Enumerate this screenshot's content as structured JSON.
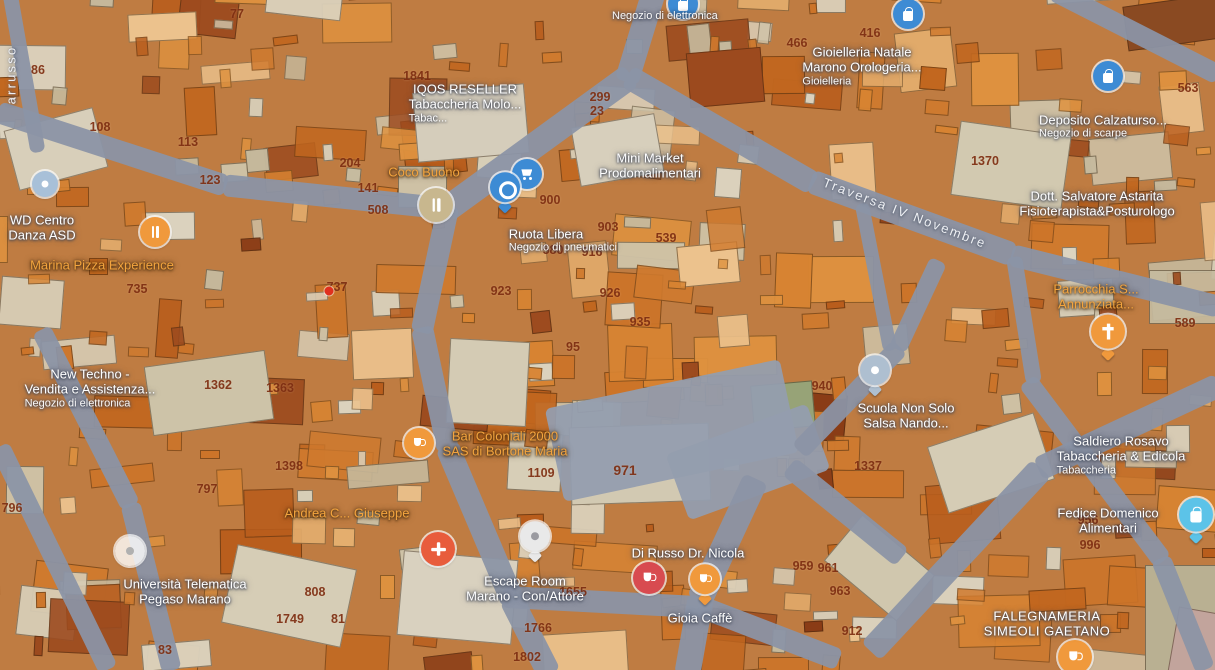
{
  "app": {
    "title": "Map view"
  },
  "map": {
    "style": {
      "base": "#bf7c42",
      "road": "#8b94a6",
      "plaza": "#949dae",
      "parcel_text": "#7d2d10",
      "label_white": "#ffffff",
      "label_amber": "#f3a43e",
      "marker_blue": "#3d8bd4",
      "marker_orange": "#f0993c",
      "marker_red": "#d84b50",
      "marker_pharma": "#e85c3c",
      "marker_cyan": "#5cc3e8"
    },
    "buildings": {
      "seed": 12345,
      "count_big": 150,
      "count_small": 230,
      "palette_orange": [
        "#c2671f",
        "#cd7428",
        "#d88432",
        "#df923f",
        "#b95d1c",
        "#d07a2e"
      ],
      "palette_tan": [
        "#cfc4a9",
        "#d8cfb9",
        "#c6bb9f",
        "#dcd4c0"
      ],
      "palette_peach": [
        "#e4ae6e",
        "#ecc28d"
      ],
      "palette_dark": [
        "#9c4a1e",
        "#8a3c16"
      ],
      "thresholds": {
        "orange": 0.6,
        "tan": 0.85,
        "peach": 0.94
      }
    },
    "patches": [
      {
        "x": 570,
        "y": 425,
        "w": 140,
        "h": 78,
        "c": "#d2c9b2",
        "deg": -2
      },
      {
        "x": 10,
        "y": 118,
        "w": 92,
        "h": 62,
        "c": "#d8cfba",
        "deg": -15
      },
      {
        "x": 148,
        "y": 358,
        "w": 122,
        "h": 70,
        "c": "#cdc3a8",
        "deg": -8
      },
      {
        "x": 228,
        "y": 556,
        "w": 122,
        "h": 80,
        "c": "#d6cdb6",
        "deg": 12
      },
      {
        "x": 935,
        "y": 428,
        "w": 112,
        "h": 70,
        "c": "#d5ccb5",
        "deg": -18
      },
      {
        "x": 955,
        "y": 128,
        "w": 112,
        "h": 75,
        "c": "#d2c9b0",
        "deg": 8
      },
      {
        "x": 415,
        "y": 88,
        "w": 112,
        "h": 70,
        "c": "#d5cdbb",
        "deg": -5
      },
      {
        "x": 832,
        "y": 538,
        "w": 95,
        "h": 60,
        "c": "#d0c7ae",
        "deg": 40
      },
      {
        "x": 448,
        "y": 340,
        "w": 80,
        "h": 85,
        "c": "#d4cbb4",
        "deg": 3
      },
      {
        "x": 575,
        "y": 120,
        "w": 85,
        "h": 60,
        "c": "#d7cfbc",
        "deg": -10
      },
      {
        "x": 400,
        "y": 555,
        "w": 115,
        "h": 85,
        "c": "#d9d1bf",
        "deg": 5
      },
      {
        "x": 1125,
        "y": 0,
        "w": 95,
        "h": 45,
        "c": "#8a4a22",
        "deg": -8
      },
      {
        "x": 688,
        "y": 50,
        "w": 75,
        "h": 55,
        "c": "#9c4a1e",
        "deg": -5
      },
      {
        "x": 1145,
        "y": 565,
        "w": 105,
        "h": 115,
        "c": "#b9b092",
        "deg": 0
      },
      {
        "x": 1172,
        "y": 612,
        "w": 70,
        "h": 75,
        "c": "#c2a49c",
        "deg": 10
      },
      {
        "x": 752,
        "y": 383,
        "w": 62,
        "h": 46,
        "c": "#97a377",
        "deg": -5
      }
    ],
    "roads": [
      {
        "cx": 112,
        "cy": 149,
        "len": 240,
        "w": 22,
        "deg": 18
      },
      {
        "cx": 336,
        "cy": 197,
        "len": 226,
        "w": 22,
        "deg": 6
      },
      {
        "cx": 641,
        "cy": 34,
        "len": 100,
        "w": 24,
        "deg": 107
      },
      {
        "cx": 538,
        "cy": 143,
        "len": 230,
        "w": 26,
        "deg": 144
      },
      {
        "cx": 435,
        "cy": 269,
        "len": 130,
        "w": 22,
        "deg": 102
      },
      {
        "cx": 435,
        "cy": 389,
        "len": 126,
        "w": 22,
        "deg": 78
      },
      {
        "cx": 480,
        "cy": 524,
        "len": 170,
        "w": 24,
        "deg": 67
      },
      {
        "cx": 530,
        "cy": 636,
        "len": 86,
        "w": 24,
        "deg": 63
      },
      {
        "cx": 720,
        "cy": 130,
        "len": 215,
        "w": 24,
        "deg": 30
      },
      {
        "cx": 912,
        "cy": 218,
        "len": 216,
        "w": 24,
        "deg": 20
      },
      {
        "cx": 1115,
        "cy": 281,
        "len": 215,
        "w": 22,
        "deg": 14
      },
      {
        "cx": 1136,
        "cy": 33,
        "len": 186,
        "w": 20,
        "deg": 27
      },
      {
        "cx": 672,
        "cy": 430,
        "len": 240,
        "w": 95,
        "deg": -12,
        "plaza": true
      },
      {
        "cx": 748,
        "cy": 462,
        "len": 150,
        "w": 70,
        "deg": -20,
        "plaza": true
      },
      {
        "cx": 727,
        "cy": 540,
        "len": 135,
        "w": 26,
        "deg": 115
      },
      {
        "cx": 694,
        "cy": 636,
        "len": 80,
        "w": 26,
        "deg": 100
      },
      {
        "cx": 602,
        "cy": 602,
        "len": 198,
        "w": 22,
        "deg": 3
      },
      {
        "cx": 769,
        "cy": 633,
        "len": 150,
        "w": 22,
        "deg": 21
      },
      {
        "cx": 1129,
        "cy": 427,
        "len": 200,
        "w": 24,
        "deg": 155
      },
      {
        "cx": 956,
        "cy": 560,
        "len": 250,
        "w": 26,
        "deg": 133
      },
      {
        "cx": 1095,
        "cy": 471,
        "len": 226,
        "w": 20,
        "deg": 53
      },
      {
        "cx": 1183,
        "cy": 614,
        "len": 120,
        "w": 20,
        "deg": 68
      },
      {
        "cx": 849,
        "cy": 399,
        "len": 145,
        "w": 20,
        "deg": -46
      },
      {
        "cx": 918,
        "cy": 305,
        "len": 98,
        "w": 18,
        "deg": -65
      },
      {
        "cx": 86,
        "cy": 418,
        "len": 198,
        "w": 20,
        "deg": 63
      },
      {
        "cx": 151,
        "cy": 587,
        "len": 172,
        "w": 20,
        "deg": 76
      },
      {
        "cx": 54,
        "cy": 558,
        "len": 248,
        "w": 20,
        "deg": 64
      },
      {
        "cx": 24,
        "cy": 72,
        "len": 162,
        "w": 15,
        "deg": 80
      },
      {
        "cx": 845,
        "cy": 512,
        "len": 145,
        "w": 22,
        "deg": 39
      },
      {
        "cx": 876,
        "cy": 277,
        "len": 150,
        "w": 14,
        "deg": 79
      },
      {
        "cx": 1024,
        "cy": 320,
        "len": 128,
        "w": 16,
        "deg": 81
      }
    ],
    "street_labels": [
      {
        "id": "traversa-iv-novembre",
        "text": "Traversa IV Novembre",
        "x": 905,
        "y": 213,
        "deg": 21
      },
      {
        "id": "arrusso",
        "text": "arrusso",
        "x": 11,
        "y": 75,
        "deg": -90
      }
    ],
    "parcels": [
      {
        "x": 237,
        "y": 14,
        "t": "77"
      },
      {
        "x": 417,
        "y": 76,
        "t": "1841"
      },
      {
        "x": 38,
        "y": 70,
        "t": "86"
      },
      {
        "x": 100,
        "y": 127,
        "t": "108"
      },
      {
        "x": 188,
        "y": 142,
        "t": "113"
      },
      {
        "x": 210,
        "y": 180,
        "t": "123"
      },
      {
        "x": 350,
        "y": 163,
        "t": "204"
      },
      {
        "x": 368,
        "y": 188,
        "t": "141"
      },
      {
        "x": 378,
        "y": 210,
        "t": "508"
      },
      {
        "x": 597,
        "y": 111,
        "t": "23"
      },
      {
        "x": 600,
        "y": 97,
        "t": "299"
      },
      {
        "x": 550,
        "y": 200,
        "t": "900"
      },
      {
        "x": 608,
        "y": 227,
        "t": "903"
      },
      {
        "x": 666,
        "y": 238,
        "t": "539"
      },
      {
        "x": 553,
        "y": 250,
        "t": "580"
      },
      {
        "x": 592,
        "y": 252,
        "t": "916"
      },
      {
        "x": 501,
        "y": 291,
        "t": "923"
      },
      {
        "x": 610,
        "y": 293,
        "t": "926"
      },
      {
        "x": 640,
        "y": 322,
        "t": "935"
      },
      {
        "x": 573,
        "y": 347,
        "t": "95"
      },
      {
        "x": 822,
        "y": 386,
        "t": "940"
      },
      {
        "x": 137,
        "y": 289,
        "t": "735"
      },
      {
        "x": 337,
        "y": 287,
        "t": "737"
      },
      {
        "x": 218,
        "y": 385,
        "t": "1362"
      },
      {
        "x": 280,
        "y": 388,
        "t": "1363"
      },
      {
        "x": 289,
        "y": 466,
        "t": "1398"
      },
      {
        "x": 207,
        "y": 489,
        "t": "797"
      },
      {
        "x": 12,
        "y": 508,
        "t": "796"
      },
      {
        "x": 315,
        "y": 592,
        "t": "808"
      },
      {
        "x": 290,
        "y": 619,
        "t": "1749"
      },
      {
        "x": 338,
        "y": 619,
        "t": "81"
      },
      {
        "x": 165,
        "y": 650,
        "t": "83"
      },
      {
        "x": 538,
        "y": 628,
        "t": "1766"
      },
      {
        "x": 527,
        "y": 657,
        "t": "1802"
      },
      {
        "x": 625,
        "y": 470,
        "t": "971",
        "s": 14
      },
      {
        "x": 541,
        "y": 473,
        "t": "1109"
      },
      {
        "x": 573,
        "y": 592,
        "t": "1655"
      },
      {
        "x": 803,
        "y": 566,
        "t": "959"
      },
      {
        "x": 828,
        "y": 568,
        "t": "961"
      },
      {
        "x": 840,
        "y": 591,
        "t": "963"
      },
      {
        "x": 852,
        "y": 631,
        "t": "912"
      },
      {
        "x": 868,
        "y": 466,
        "t": "1337"
      },
      {
        "x": 985,
        "y": 161,
        "t": "1370"
      },
      {
        "x": 797,
        "y": 43,
        "t": "466"
      },
      {
        "x": 870,
        "y": 33,
        "t": "416"
      },
      {
        "x": 1188,
        "y": 88,
        "t": "563"
      },
      {
        "x": 1185,
        "y": 323,
        "t": "589"
      },
      {
        "x": 1088,
        "y": 520,
        "t": "956"
      },
      {
        "x": 1090,
        "y": 545,
        "t": "996"
      }
    ],
    "pois": [
      {
        "id": "iqos-reseller",
        "x": 465,
        "y": 97,
        "lines": [
          "IQOS RESELLER",
          "Tabaccheria Molo..."
        ],
        "sub": "Tabac...",
        "color": "white"
      },
      {
        "id": "negozio-elettronica-top",
        "x": 612,
        "y": 10,
        "lines": [],
        "sub": "Negozio di elettronica",
        "color": "white"
      },
      {
        "id": "coco-buono",
        "x": 424,
        "y": 172,
        "lines": [
          "Coco Buono"
        ],
        "sub": "",
        "color": "amber"
      },
      {
        "id": "mini-market-prodomalimentari",
        "x": 650,
        "y": 166,
        "lines": [
          "Mini Market",
          "Prodomalimentari"
        ],
        "sub": "",
        "color": "white"
      },
      {
        "id": "ruota-libera",
        "x": 546,
        "y": 234,
        "lines": [
          "Ruota Libera"
        ],
        "sub": "Negozio di pneumatici",
        "color": "white"
      },
      {
        "id": "gioielleria-natale",
        "x": 862,
        "y": 60,
        "lines": [
          "Gioielleria Natale",
          "Marono Orologeria..."
        ],
        "sub": "Gioielleria",
        "color": "white"
      },
      {
        "id": "deposito-calzature",
        "x": 1103,
        "y": 120,
        "lines": [
          "Deposito Calzaturso..."
        ],
        "sub": "Negozio di scarpe",
        "color": "white"
      },
      {
        "id": "dott-salvatore-astarita",
        "x": 1097,
        "y": 204,
        "lines": [
          "Dott. Salvatore Astarita",
          "Fisioterapista&Posturologo"
        ],
        "sub": "",
        "color": "white"
      },
      {
        "id": "wd-centro-danza",
        "x": 42,
        "y": 228,
        "lines": [
          "WD Centro",
          "Danza ASD"
        ],
        "sub": "",
        "color": "white"
      },
      {
        "id": "marina-pizza-experience",
        "x": 102,
        "y": 265,
        "lines": [
          "Marina Pizza Experience"
        ],
        "sub": "",
        "color": "amber"
      },
      {
        "id": "new-techno",
        "x": 90,
        "y": 382,
        "lines": [
          "New Techno -",
          "Vendita e Assistenza..."
        ],
        "sub": "Negozio di elettronica",
        "color": "white"
      },
      {
        "id": "bar-coloniali-2000",
        "x": 505,
        "y": 444,
        "lines": [
          "Bar Coloniali 2000",
          "SAS di Bortone Maria"
        ],
        "sub": "",
        "color": "amber"
      },
      {
        "id": "andrea-giuseppe",
        "x": 347,
        "y": 513,
        "lines": [
          "Andrea C... Giuseppe"
        ],
        "sub": "",
        "color": "amber"
      },
      {
        "id": "escape-room-marano",
        "x": 525,
        "y": 589,
        "lines": [
          "Escape Room",
          "Marano - Con/Attore"
        ],
        "sub": "",
        "color": "white"
      },
      {
        "id": "di-russo-dr-nicola",
        "x": 688,
        "y": 553,
        "lines": [
          "Di Russo Dr. Nicola"
        ],
        "sub": "",
        "color": "white"
      },
      {
        "id": "gioia-caffe",
        "x": 700,
        "y": 618,
        "lines": [
          "Gioia Caffè"
        ],
        "sub": "",
        "color": "white"
      },
      {
        "id": "universita-telematica-pegaso",
        "x": 185,
        "y": 592,
        "lines": [
          "Università Telematica",
          "Pegaso Marano"
        ],
        "sub": "",
        "color": "white"
      },
      {
        "id": "scuola-non-solo-salsa",
        "x": 906,
        "y": 416,
        "lines": [
          "Scuola Non Solo",
          "Salsa Nando..."
        ],
        "sub": "",
        "color": "white"
      },
      {
        "id": "saldiero-tabaccheria",
        "x": 1121,
        "y": 449,
        "lines": [
          "Saldiero Rosavo",
          "Tabaccheria & Edicola"
        ],
        "sub": "Tabaccheria",
        "color": "white"
      },
      {
        "id": "fedice-domenico-alimentari",
        "x": 1108,
        "y": 521,
        "lines": [
          "Fedice Domenico",
          "Alimentari"
        ],
        "sub": "",
        "color": "white"
      },
      {
        "id": "parrocchia-annunziata",
        "x": 1096,
        "y": 297,
        "lines": [
          "Parrocchia S...",
          "Annunziata..."
        ],
        "sub": "",
        "color": "amber"
      },
      {
        "id": "falegnameria-simeoli",
        "x": 1047,
        "y": 624,
        "lines": [
          "FALEGNAMERIA",
          "SIMEOLI GAETANO"
        ],
        "sub": "",
        "color": "white",
        "caps": true
      }
    ],
    "markers": [
      {
        "id": "mini-market",
        "x": 527,
        "y": 174,
        "kind": "circle",
        "color": "#3d8bd4",
        "glyph": "cart",
        "size": 30,
        "g": "#ffffff"
      },
      {
        "id": "ruota-libera",
        "x": 505,
        "y": 192,
        "kind": "pin",
        "color": "#3d8bd4",
        "glyph": "tire",
        "size": 30,
        "g": "#ffffff"
      },
      {
        "id": "gioielleria",
        "x": 908,
        "y": 14,
        "kind": "circle",
        "color": "#3d8bd4",
        "glyph": "bag",
        "size": 30,
        "g": "#ffffff"
      },
      {
        "id": "deposito-calzature",
        "x": 1108,
        "y": 76,
        "kind": "circle",
        "color": "#3d8bd4",
        "glyph": "bag",
        "size": 30,
        "g": "#ffffff"
      },
      {
        "id": "negozio-top-edge",
        "x": 683,
        "y": 4,
        "kind": "circle",
        "color": "#3d8bd4",
        "glyph": "bag",
        "size": 30,
        "g": "#ffffff"
      },
      {
        "id": "coco-buono",
        "x": 436,
        "y": 205,
        "kind": "circle",
        "color": "#c8b78e",
        "glyph": "fork",
        "size": 34,
        "g": "#ffffff"
      },
      {
        "id": "marina-pizza",
        "x": 155,
        "y": 232,
        "kind": "circle",
        "color": "#f0993c",
        "glyph": "fork",
        "size": 30,
        "g": "#ffffff"
      },
      {
        "id": "wd-centro",
        "x": 45,
        "y": 184,
        "kind": "circle",
        "color": "#a8c0d8",
        "glyph": "dot",
        "size": 26,
        "g": "#ffffff"
      },
      {
        "id": "bar-coloniali",
        "x": 419,
        "y": 443,
        "kind": "circle",
        "color": "#f0993c",
        "glyph": "cup",
        "size": 30,
        "g": "#ffffff"
      },
      {
        "id": "farmacia-cross",
        "x": 438,
        "y": 549,
        "kind": "circle",
        "color": "#e85c3c",
        "glyph": "cross",
        "size": 34,
        "g": "#ffffff"
      },
      {
        "id": "escape-room",
        "x": 535,
        "y": 541,
        "kind": "pin",
        "color": "#e9e9e9",
        "glyph": "dot",
        "size": 30,
        "g": "#9a9aa0"
      },
      {
        "id": "di-russo",
        "x": 649,
        "y": 578,
        "kind": "circle",
        "color": "#d84b50",
        "glyph": "cup",
        "size": 32,
        "g": "#ffffff"
      },
      {
        "id": "gioia-caffe",
        "x": 705,
        "y": 584,
        "kind": "pin",
        "color": "#f0993c",
        "glyph": "cup",
        "size": 30,
        "g": "#ffffff"
      },
      {
        "id": "parrocchia-church",
        "x": 1108,
        "y": 337,
        "kind": "pin",
        "color": "#f0993c",
        "glyph": "church",
        "size": 34,
        "g": "#ffffff"
      },
      {
        "id": "scuola-salsa",
        "x": 875,
        "y": 375,
        "kind": "pin",
        "color": "#aebfd0",
        "glyph": "dot",
        "size": 30,
        "g": "#ffffff"
      },
      {
        "id": "fedice-domenico",
        "x": 1196,
        "y": 520,
        "kind": "pin",
        "color": "#5cc3e8",
        "glyph": "bag",
        "size": 34,
        "g": "#ffffff"
      },
      {
        "id": "universita",
        "x": 130,
        "y": 551,
        "kind": "circle",
        "color": "rgba(255,255,255,0.8)",
        "glyph": "dot",
        "size": 30,
        "g": "#b0b0b0"
      },
      {
        "id": "falegnameria-area",
        "x": 1075,
        "y": 657,
        "kind": "circle",
        "color": "#f0993c",
        "glyph": "cup",
        "size": 34,
        "g": "#ffffff"
      },
      {
        "id": "red-dot",
        "x": 329,
        "y": 291,
        "kind": "dot",
        "color": "#e0301e",
        "size": 9
      }
    ]
  }
}
